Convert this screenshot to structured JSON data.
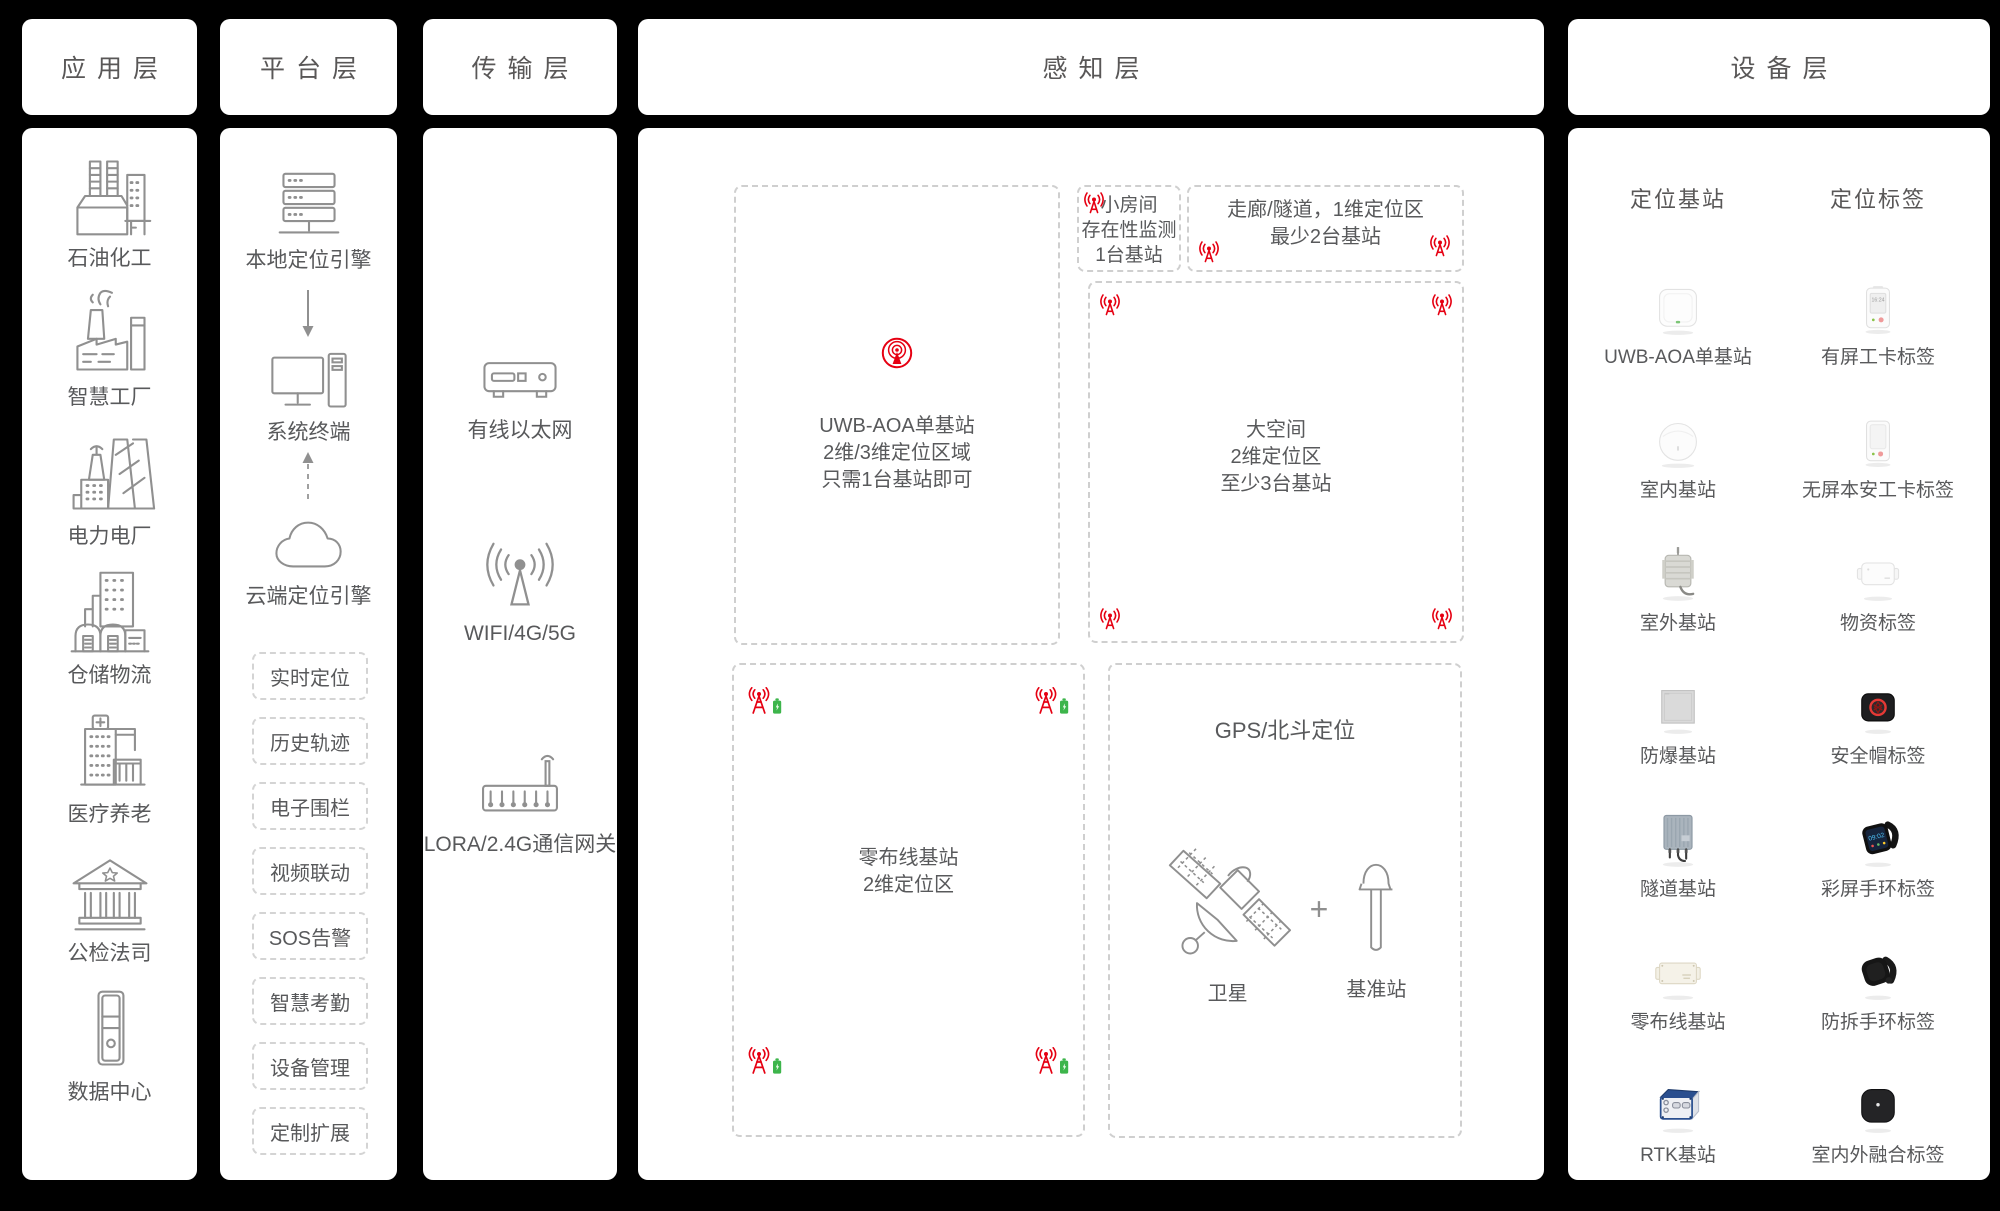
{
  "colors": {
    "background": "#000000",
    "panel": "#ffffff",
    "text": "#58595b",
    "dashed_border": "#cfcfcf",
    "accent_red": "#e60012",
    "accent_green": "#3db54b"
  },
  "headers": {
    "application": "应用层",
    "platform": "平台层",
    "transmission": "传输层",
    "perception": "感知层",
    "device": "设备层"
  },
  "application": {
    "items": [
      {
        "label": "石油化工"
      },
      {
        "label": "智慧工厂"
      },
      {
        "label": "电力电厂"
      },
      {
        "label": "仓储物流"
      },
      {
        "label": "医疗养老"
      },
      {
        "label": "公检法司"
      },
      {
        "label": "数据中心"
      }
    ]
  },
  "platform": {
    "nodes": [
      {
        "label": "本地定位引擎"
      },
      {
        "label": "系统终端"
      },
      {
        "label": "云端定位引擎"
      }
    ],
    "functions": [
      "实时定位",
      "历史轨迹",
      "电子围栏",
      "视频联动",
      "SOS告警",
      "智慧考勤",
      "设备管理",
      "定制扩展"
    ]
  },
  "transmission": {
    "items": [
      {
        "label": "有线以太网"
      },
      {
        "label": "WIFI/4G/5G"
      },
      {
        "label": "LORA/2.4G通信网关"
      }
    ]
  },
  "perception": {
    "uwb_zone": {
      "lines": [
        "UWB-AOA单基站",
        "2维/3维定位区域",
        "只需1台基站即可"
      ]
    },
    "small_room_zone": {
      "lines": [
        "小房间",
        "存在性监测",
        "1台基站"
      ]
    },
    "corridor_zone": {
      "lines": [
        "走廊/隧道，1维定位区",
        "最少2台基站"
      ]
    },
    "large_space_zone": {
      "lines": [
        "大空间",
        "2维定位区",
        "至少3台基站"
      ]
    },
    "zero_wiring_zone": {
      "lines": [
        "零布线基站",
        "2维定位区"
      ]
    },
    "gps_zone": {
      "title": "GPS/北斗定位",
      "satellite_label": "卫星",
      "plus": "+",
      "base_label": "基准站"
    }
  },
  "device": {
    "station_header": "定位基站",
    "tag_header": "定位标签",
    "rows": [
      {
        "station": "UWB-AOA单基站",
        "tag": "有屏工卡标签"
      },
      {
        "station": "室内基站",
        "tag": "无屏本安工卡标签"
      },
      {
        "station": "室外基站",
        "tag": "物资标签"
      },
      {
        "station": "防爆基站",
        "tag": "安全帽标签"
      },
      {
        "station": "隧道基站",
        "tag": "彩屏手环标签"
      },
      {
        "station": "零布线基站",
        "tag": "防拆手环标签"
      },
      {
        "station": "RTK基站",
        "tag": "室内外融合标签"
      }
    ],
    "badge_time": "16:24",
    "watch_time": "09:02"
  }
}
